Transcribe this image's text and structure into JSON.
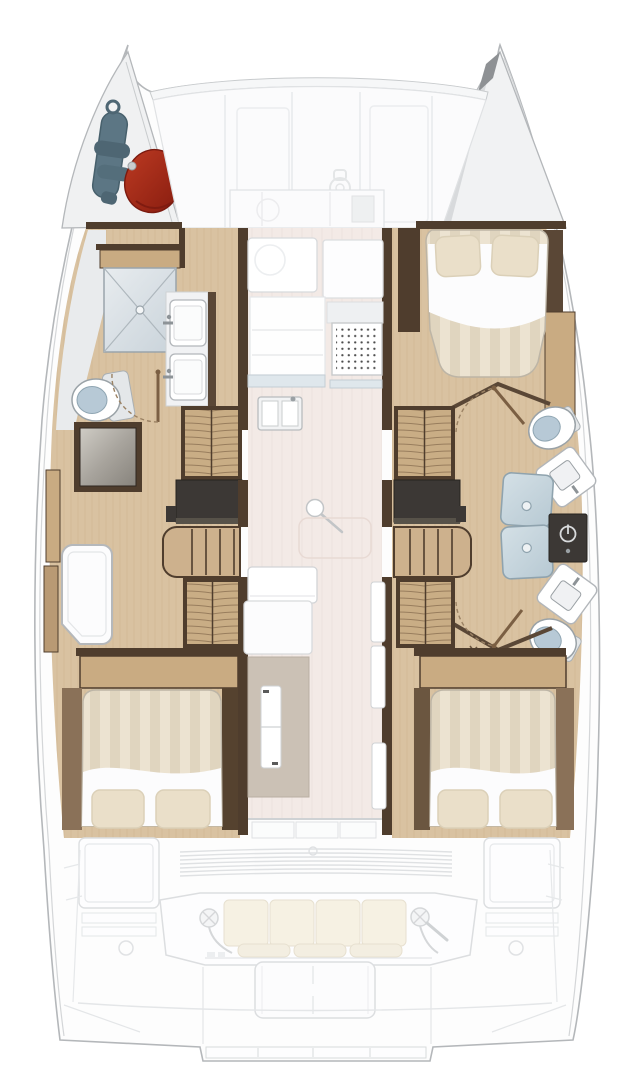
{
  "meta": {
    "title": "Sailing catamaran interior deck plan, overhead view",
    "diagram_type": "boat-floor-plan",
    "orientation": "bow at top, stern at bottom"
  },
  "palette": {
    "deck_white": "#fdfdfd",
    "hull_stroke": "#b4b7ba",
    "faded": "#dfe1e3",
    "wood_floor": "#d9c2a1",
    "wood_mid": "#c9ab82",
    "wood_dark": "#8a7158",
    "wall_brown": "#4f3d2d",
    "charcoal": "#3c3835",
    "stairs_wood": "#cdb18d",
    "saloon_floor": "#f3eae6",
    "bed_a": "#ece3d1",
    "bed_b": "#e0d5bf",
    "pillow": "#eadfc9",
    "cushion": "#f6f1e3",
    "toilet_lid": "#b7c9d6",
    "rope_blue": "#5c7684",
    "fender_red": "#a62b1d",
    "fixture_white": "#ffffff"
  },
  "areas": {
    "bow": {
      "port_locker_contents": [
        "coiled-mooring-rope",
        "red-fender"
      ],
      "starboard_locker_contents": []
    },
    "foredeck": {
      "panels": 4,
      "windlass_glyph": true,
      "crossbeam": true
    },
    "port_hull": {
      "features": [
        "shower-with-cross",
        "toilet",
        "washbasin",
        "washbasin",
        "shower-tray",
        "door-arc",
        "hanging-locker",
        "charcoal-counter",
        "companion-stairs",
        "hanging-locker",
        "white-bench-seat",
        "aft-double-bed"
      ],
      "bed_pillows": 2
    },
    "starboard_hull": {
      "features": [
        "forward-double-bed",
        "door-arc",
        "toilet",
        "washbasin",
        "shower-glass-doors",
        "shower-control-panel",
        "washbasin",
        "toilet",
        "door-arc",
        "hanging-locker",
        "charcoal-counter",
        "companion-stairs",
        "hanging-locker",
        "boat-hook",
        "aft-double-bed"
      ],
      "forward_bed_pillows": 2,
      "aft_bed_pillows": 2
    },
    "saloon": {
      "features": [
        "cabinet-row",
        "galley-cabinet",
        "galley-cabinet",
        "galley-panel",
        "hob-grill",
        "counter-edge",
        "double-sink",
        "mast-foot",
        "table-outline",
        "sofa-backrest",
        "sofa-seat",
        "chart-table",
        "table-leaf",
        "companionway-step",
        "companionway-step",
        "companionway-step",
        "sliding-door"
      ]
    },
    "cockpit": {
      "features": [
        "louver-vent",
        "port-storage-box",
        "starboard-storage-box",
        "aft-bench",
        "winch",
        "winch",
        "cockpit-table-platform",
        "transom-platform"
      ],
      "bench_back_cushions": 4,
      "bench_seat_cushions": 3
    }
  },
  "counts": {
    "double_beds": 3,
    "toilets": 3,
    "washbasins_hulls": 4,
    "showers": 2,
    "hanging_lockers": 4,
    "winches": 2
  }
}
